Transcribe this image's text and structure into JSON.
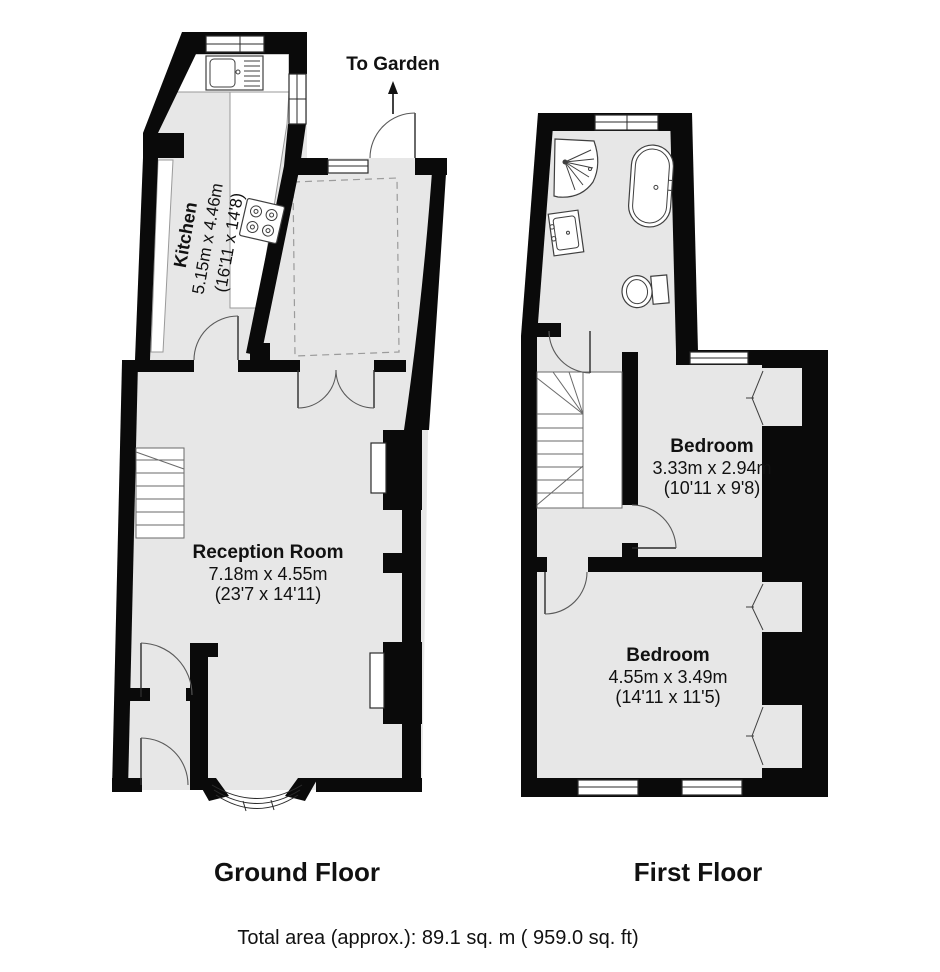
{
  "floors": {
    "ground": {
      "label": "Ground Floor",
      "rooms": {
        "kitchen": {
          "name": "Kitchen",
          "metric": "5.15m x 4.46m",
          "imperial": "(16'11 x 14'8)"
        },
        "reception": {
          "name": "Reception Room",
          "metric": "7.18m x 4.55m",
          "imperial": "(23'7 x 14'11)"
        }
      },
      "annotations": {
        "to_garden": "To Garden"
      }
    },
    "first": {
      "label": "First Floor",
      "rooms": {
        "bedroom1": {
          "name": "Bedroom",
          "metric": "3.33m x 2.94m",
          "imperial": "(10'11 x 9'8)"
        },
        "bedroom2": {
          "name": "Bedroom",
          "metric": "4.55m x 3.49m",
          "imperial": "(14'11 x 11'5)"
        }
      }
    }
  },
  "footer": {
    "total_area": "Total area (approx.): 89.1 sq. m ( 959.0 sq. ft)"
  },
  "colors": {
    "wall": "#0a0a0a",
    "floor": "#e7e7e7",
    "stair_fill": "#ffffff",
    "dashed_outline": "#9b9b9b"
  }
}
